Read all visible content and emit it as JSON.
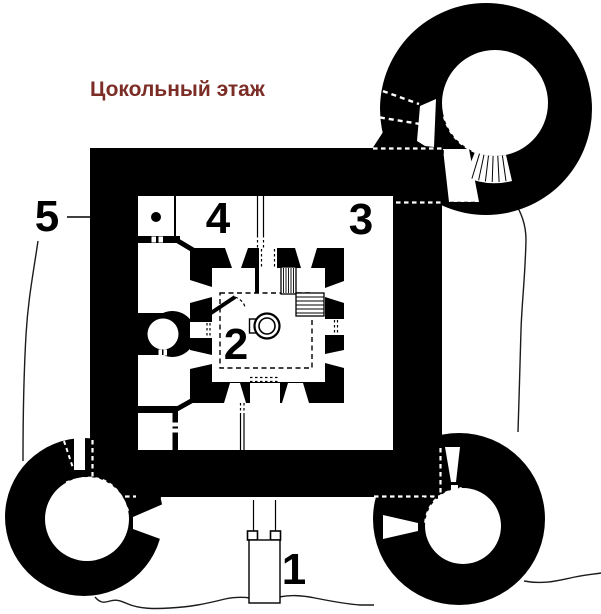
{
  "title": {
    "text": "Цокольный этаж",
    "color": "#7b2d26"
  },
  "labels": {
    "n1": "1",
    "n2": "2",
    "n3": "3",
    "n4": "4",
    "n5": "5"
  },
  "colors": {
    "ink": "#000000",
    "paper": "#ffffff",
    "terrain": "#1b1b1b"
  }
}
